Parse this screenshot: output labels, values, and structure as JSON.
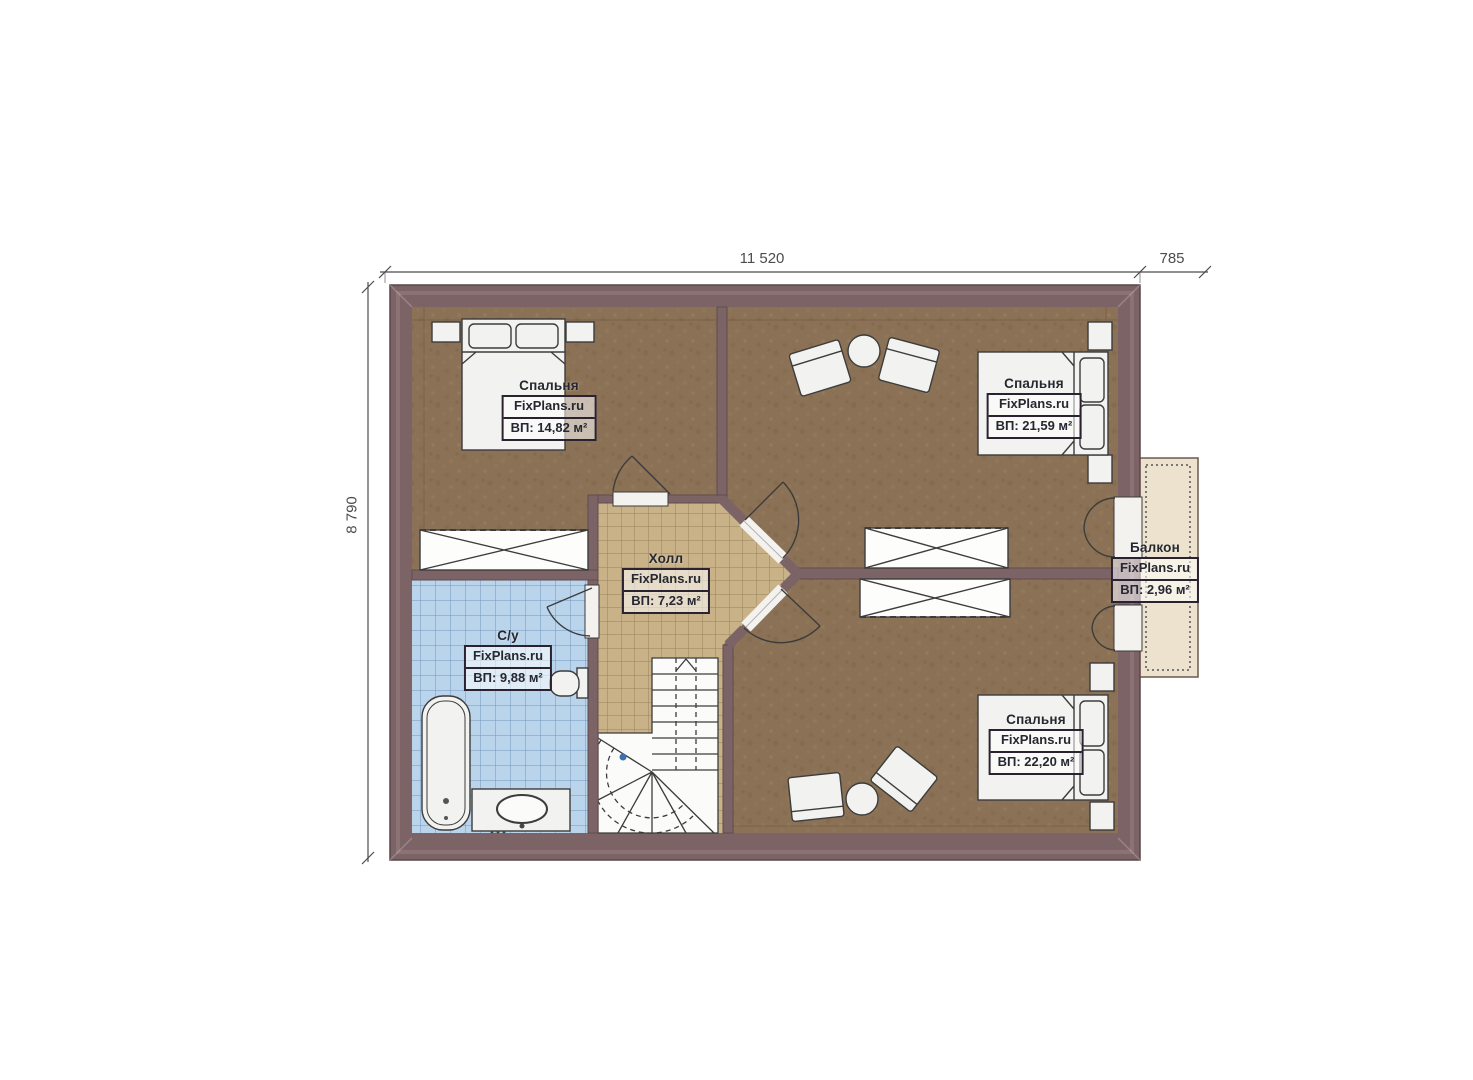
{
  "title": "Floor plan — attic level",
  "watermark": "FixPlans.ru",
  "dimensions": {
    "top_width": "11 520",
    "balcony_width": "785",
    "left_height": "8 790"
  },
  "rooms": [
    {
      "id": "bedroom-top-left",
      "name": "Спальня",
      "area": "ВП: 14,82 м²"
    },
    {
      "id": "bedroom-top-right",
      "name": "Спальня",
      "area": "ВП: 21,59 м²"
    },
    {
      "id": "hall",
      "name": "Холл",
      "area": "ВП: 7,23 м²"
    },
    {
      "id": "bathroom",
      "name": "С/у",
      "area": "ВП: 9,88 м²"
    },
    {
      "id": "bedroom-bottom-right",
      "name": "Спальня",
      "area": "ВП: 22,20 м²"
    },
    {
      "id": "balcony",
      "name": "Балкон",
      "area": "ВП: 2,96 м²"
    }
  ],
  "colors": {
    "wall": "#7c6366",
    "wall_highlight": "#977f82",
    "bedroom_floor": "#8b7156",
    "hall_floor": "#c9b287",
    "bathroom_floor": "#bad4ec",
    "balcony_floor": "#ece2cd",
    "furniture_fill": "#f2f2f0",
    "line": "#3c3c3c",
    "dimension": "#4c4c4c",
    "walkline_dot": "#3f6fae"
  }
}
